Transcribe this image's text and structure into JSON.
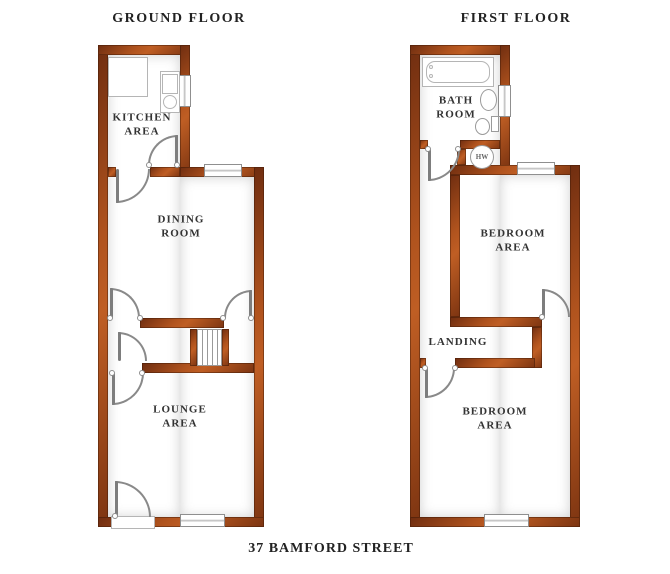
{
  "footer": {
    "address": "37 BAMFORD STREET"
  },
  "ground_floor": {
    "title": "GROUND FLOOR",
    "labels": {
      "kitchen": "KITCHEN\nAREA",
      "dining": "DINING\nROOM",
      "lounge": "LOUNGE\nAREA"
    }
  },
  "first_floor": {
    "title": "FIRST FLOOR",
    "labels": {
      "bathroom": "BATH\nROOM",
      "bedroom_middle": "BEDROOM\nAREA",
      "landing": "LANDING",
      "bedroom_front": "BEDROOM\nAREA"
    },
    "hot_water_label": "HW"
  },
  "colors": {
    "wall": "#a84c1b",
    "wall_outline": "#53200a",
    "door_arc": "#898989",
    "text": "#333333"
  }
}
